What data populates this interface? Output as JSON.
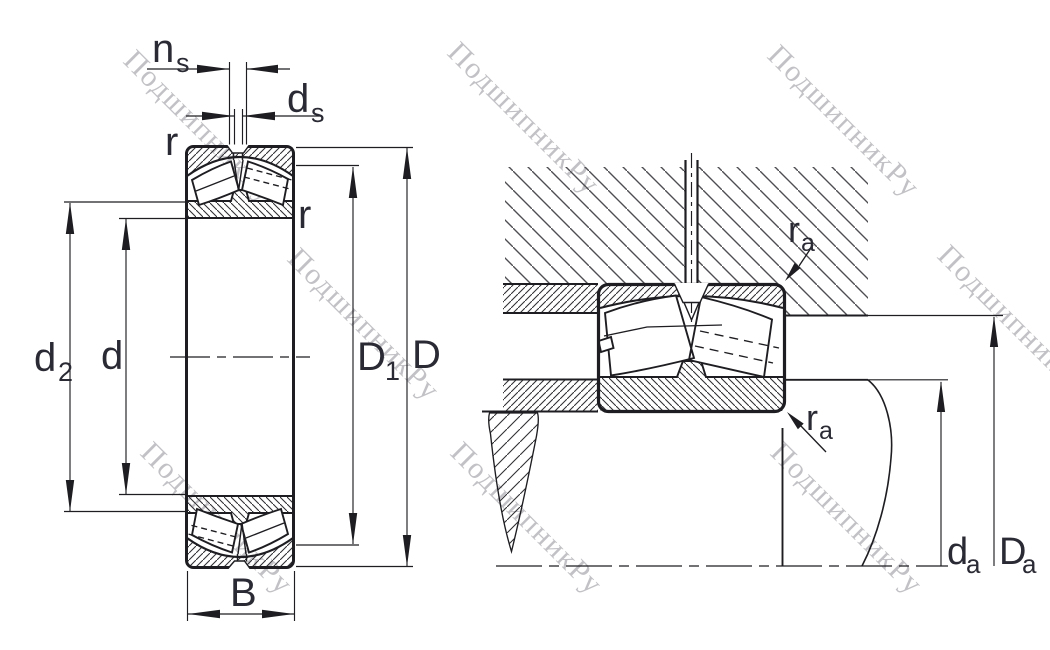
{
  "drawing": {
    "type": "spherical roller bearing dimension drawing",
    "watermark_text": "ПодшипникРу"
  },
  "colors": {
    "background": "#ffffff",
    "line": "#1e1e22",
    "label": "#2a2a34",
    "hatch-fine": "#303034",
    "hatch-coarse": "#4e4e52",
    "watermark": "#c2c2c6"
  },
  "left_figure": {
    "description": "bearing cross-section with boundary dimensions",
    "labels": {
      "ns_main": "n",
      "ns_sub": "s",
      "ds_main": "d",
      "ds_sub": "s",
      "r_top": "r",
      "r_side": "r",
      "d2_main": "d",
      "d2_sub": "2",
      "d_main": "d",
      "D1_main": "D",
      "D1_sub": "1",
      "D_main": "D",
      "B_main": "B"
    }
  },
  "right_figure": {
    "description": "bearing mounted in housing on shaft with abutment dimensions",
    "labels": {
      "ra_top_main": "r",
      "ra_top_sub": "a",
      "ra_bottom_main": "r",
      "ra_bottom_sub": "a",
      "da_main": "d",
      "da_sub": "a",
      "Da_main": "D",
      "Da_sub": "a"
    }
  }
}
